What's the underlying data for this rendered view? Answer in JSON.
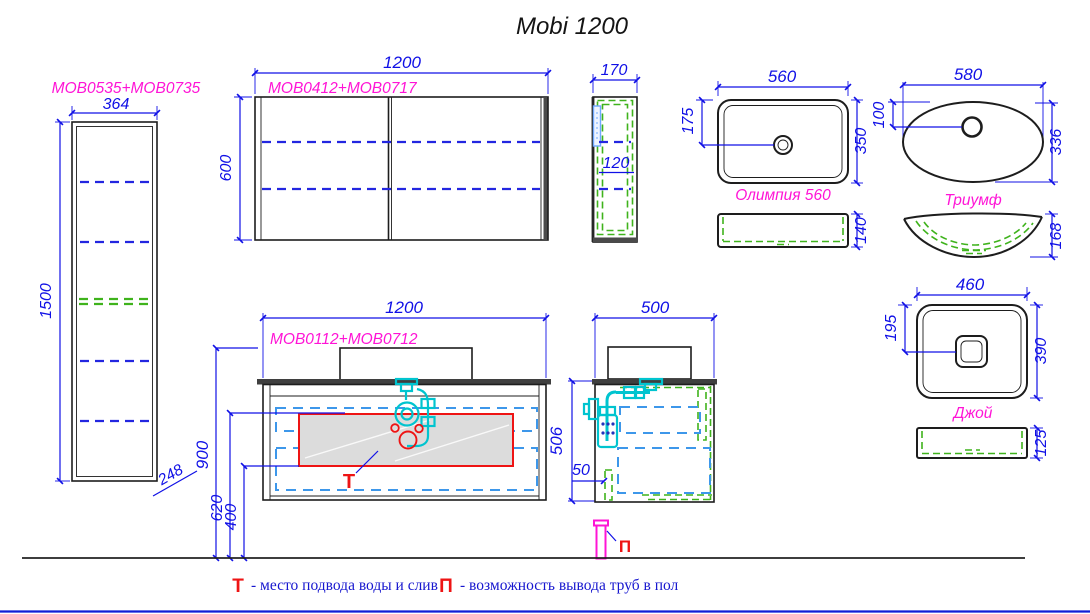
{
  "title": "Mobi 1200",
  "tall_cabinet": {
    "label": "MOB0535+MOB0735",
    "width": "364",
    "height": "1500",
    "depth": "248"
  },
  "mirror_cabinet": {
    "label": "MOB0412+MOB0717",
    "width": "1200",
    "height": "600",
    "side_depth": "170",
    "shelf_spacing": "120"
  },
  "sink_olimpia": {
    "label": "Олимпия 560",
    "width": "560",
    "depth": "350",
    "drain_offset": "175",
    "height": "140"
  },
  "sink_triumf": {
    "label": "Триумф",
    "width": "580",
    "depth": "336",
    "drain_offset": "100",
    "height": "168"
  },
  "sink_joy": {
    "label": "Джой",
    "width": "460",
    "depth": "390",
    "drain_offset": "195",
    "height": "125"
  },
  "vanity": {
    "label": "MOB0112+MOB0712",
    "width": "1200",
    "mount_height": "900",
    "supply_zone_top": "620",
    "supply_zone_bottom": "400",
    "body_height": "506",
    "water_mark": "Т",
    "side_depth": "500",
    "back_gap": "50",
    "floor_pipe_mark": "П"
  },
  "legend": {
    "water_symbol": "Т",
    "water_text": "- место подвода воды и слив",
    "pipe_symbol": "П",
    "pipe_text": "- возможность вывода труб в пол"
  },
  "colors": {
    "dimension": "#1010e6",
    "product_label": "#ff14d6",
    "hidden_green": "#3fb31c",
    "plumbing_cyan": "#00c4cf",
    "drawer_blue": "#3d97ea",
    "marker_red": "#ee1414",
    "floor_pipe": "#ff14d6"
  }
}
